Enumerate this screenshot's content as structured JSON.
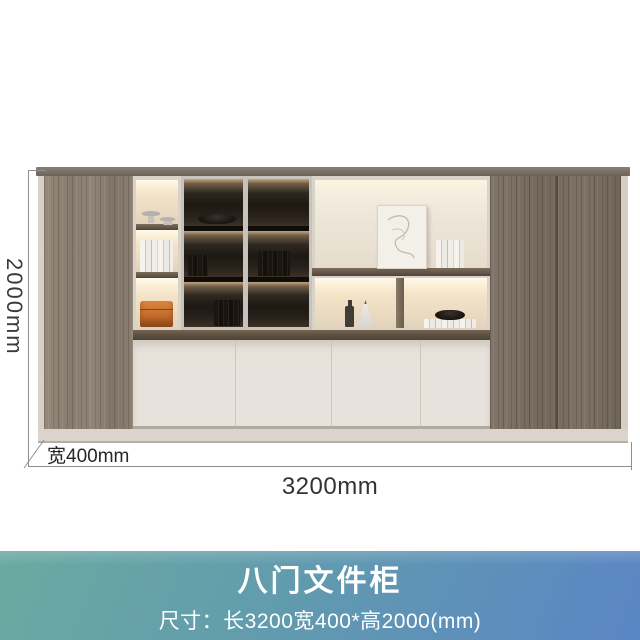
{
  "annotations": {
    "height_label": "2000mm",
    "depth_label": "宽400mm",
    "width_label": "3200mm"
  },
  "banner": {
    "title": "八门文件柜",
    "subtitle": "尺寸：长3200宽400*高2000(mm)",
    "gradient_start": "#6baaa1",
    "gradient_end": "#5b85c5",
    "text_color": "#ffffff"
  },
  "cabinet": {
    "bottom_door_count": 4,
    "glass_door_count": 2,
    "side_wood_panels": 2,
    "decor_items": [
      "pedestal-dishes",
      "white-book-stack",
      "orange-storage-box",
      "glass-cabinet-bowl",
      "glass-cabinet-books",
      "art-print",
      "standing-books",
      "dark-bottle",
      "white-cone-vase",
      "bowl-on-books"
    ]
  },
  "colors": {
    "wood_light": "#8d8173",
    "wood_dark": "#7b7063",
    "frame_light": "#d8d1c8",
    "door_cream": "#e7e2db",
    "shelf_wood": "#6f6052",
    "warm_light": "#fdf2da",
    "glass_dark": "#1d1813",
    "accent_orange": "#c9712f",
    "dimension_line": "#8f8f8f",
    "dimension_text": "#333333"
  }
}
